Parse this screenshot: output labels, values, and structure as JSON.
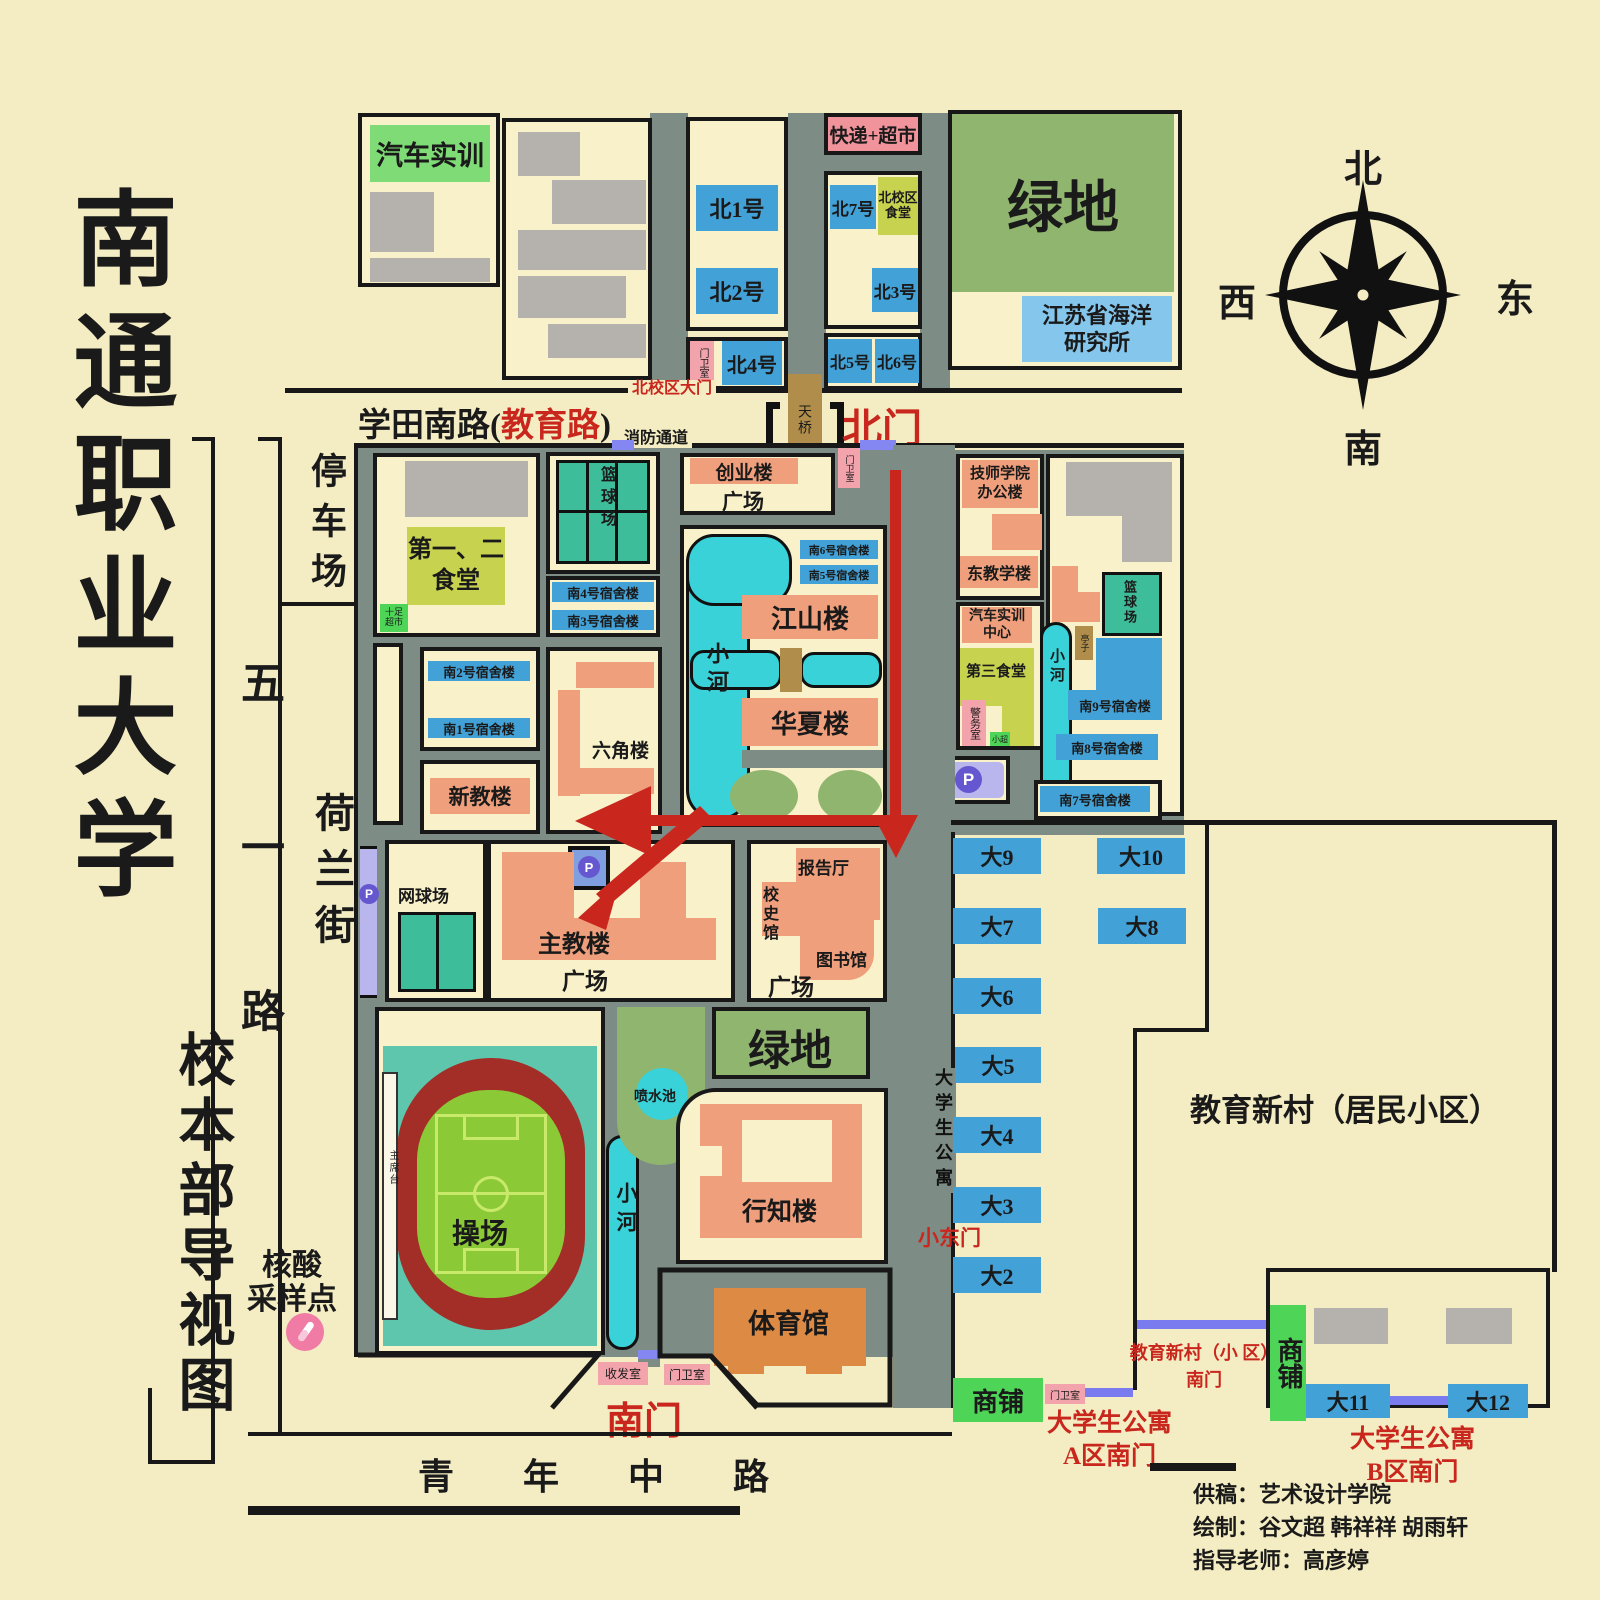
{
  "title": {
    "school_name": "南通职业大学",
    "caption": "校本部导视图"
  },
  "compass": {
    "north": "北",
    "south": "南",
    "east": "东",
    "west": "西"
  },
  "roads": {
    "xuetian_black1": "学田南路(",
    "xuetian_red": "教育路",
    "xuetian_black2": ")",
    "qingnian": "青 年 中 路",
    "wuyi": "五一路",
    "helan": "荷兰街",
    "fire_lane": "消防通道",
    "north_campus_gate": "北校区大门",
    "student_apartment": "大学生公寓"
  },
  "gates": {
    "north_gate": "北门",
    "south_gate": "南门",
    "small_east_gate": "小东门",
    "footbridge": "天桥",
    "gate_a_line1": "大学生公寓",
    "gate_a_line2": "A区南门",
    "gate_b_line1": "大学生公寓",
    "gate_b_line2": "B区南门",
    "xincun_gate_line1": "教育新村（小 区）",
    "xincun_gate_line2": "南门"
  },
  "north_campus": {
    "auto_training": "汽车实训",
    "b1": "北1号",
    "b2": "北2号",
    "b3": "北3号",
    "b4": "北4号",
    "b5": "北5号",
    "b6": "北6号",
    "b7": "北7号",
    "canteen": "北校区食堂",
    "express_market": "快递+超市",
    "guard_room": "门卫室",
    "green_field": "绿地",
    "ocean_institute_line1": "江苏省海洋",
    "ocean_institute_line2": "研究所"
  },
  "campus": {
    "parking_lot": "停车场",
    "canteen12_line1": "第一、二",
    "canteen12_line2": "食堂",
    "shizu_market_line1": "十足",
    "shizu_market_line2": "超市",
    "basketball": "篮球场",
    "dorm_s4": "南4号宿舍楼",
    "dorm_s3": "南3号宿舍楼",
    "dorm_s2": "南2号宿舍楼",
    "dorm_s1": "南1号宿舍楼",
    "new_teaching": "新教楼",
    "hexagon": "六角楼",
    "chuangye": "创业楼",
    "plaza": "广场",
    "dorm_s6": "南6号宿舍楼",
    "dorm_s5": "南5号宿舍楼",
    "jiangshan": "江山楼",
    "river": "小河",
    "huaxia": "华夏楼",
    "tennis": "网球场",
    "main_teaching": "主教楼",
    "lecture_hall": "报告厅",
    "history_hall": "校史馆",
    "library": "图书馆",
    "green_field": "绿地",
    "fountain": "喷水池",
    "xingzhi": "行知楼",
    "playground": "操场",
    "rostrum": "主席台",
    "gym": "体育馆",
    "mail_room": "收发室",
    "guard_room": "门卫室",
    "nucleic_line1": "核酸",
    "nucleic_line2": "采样点"
  },
  "east_campus": {
    "jishi_line1": "技师学院",
    "jishi_line2": "办公楼",
    "east_teaching": "东教学楼",
    "auto_center_line1": "汽车实训",
    "auto_center_line2": "中心",
    "canteen3": "第三食堂",
    "police_room": "警务室",
    "mini_market": "小超",
    "basketball": "篮球场",
    "pavilion": "亭子",
    "dorm_s9": "南9号宿舍楼",
    "dorm_s8": "南8号宿舍楼",
    "dorm_s7": "南7号宿舍楼"
  },
  "residential": {
    "name": "教育新村（居民小区）",
    "shops": "商铺",
    "d9": "大9",
    "d10": "大10",
    "d7": "大7",
    "d8": "大8",
    "d6": "大6",
    "d5": "大5",
    "d4": "大4",
    "d3": "大3",
    "d2": "大2",
    "d11": "大11",
    "d12": "大12"
  },
  "credits": {
    "line1": "供稿：艺术设计学院",
    "line2": "绘制：谷文超  韩祥祥  胡雨轩",
    "line3": "指导老师：高彦婷"
  },
  "icons": {
    "parking": "P"
  },
  "colors": {
    "background": "#f4edc3",
    "road": "#7d8c84",
    "building_salmon": "#ef9f7c",
    "dorm_blue": "#42a1d6",
    "green_field": "#8fb56e",
    "canteen_green": "#c7d24f",
    "court_teal": "#3ebd9a",
    "river_cyan": "#38d2d8",
    "guard_pink": "#f2a3ab",
    "shop_green": "#4ed457",
    "bridge_tan": "#b08d4a",
    "parking_purple": "#b9b6ee",
    "route_red": "#c9271d",
    "track_red": "#a32e28",
    "pitch_green": "#8cc937"
  }
}
